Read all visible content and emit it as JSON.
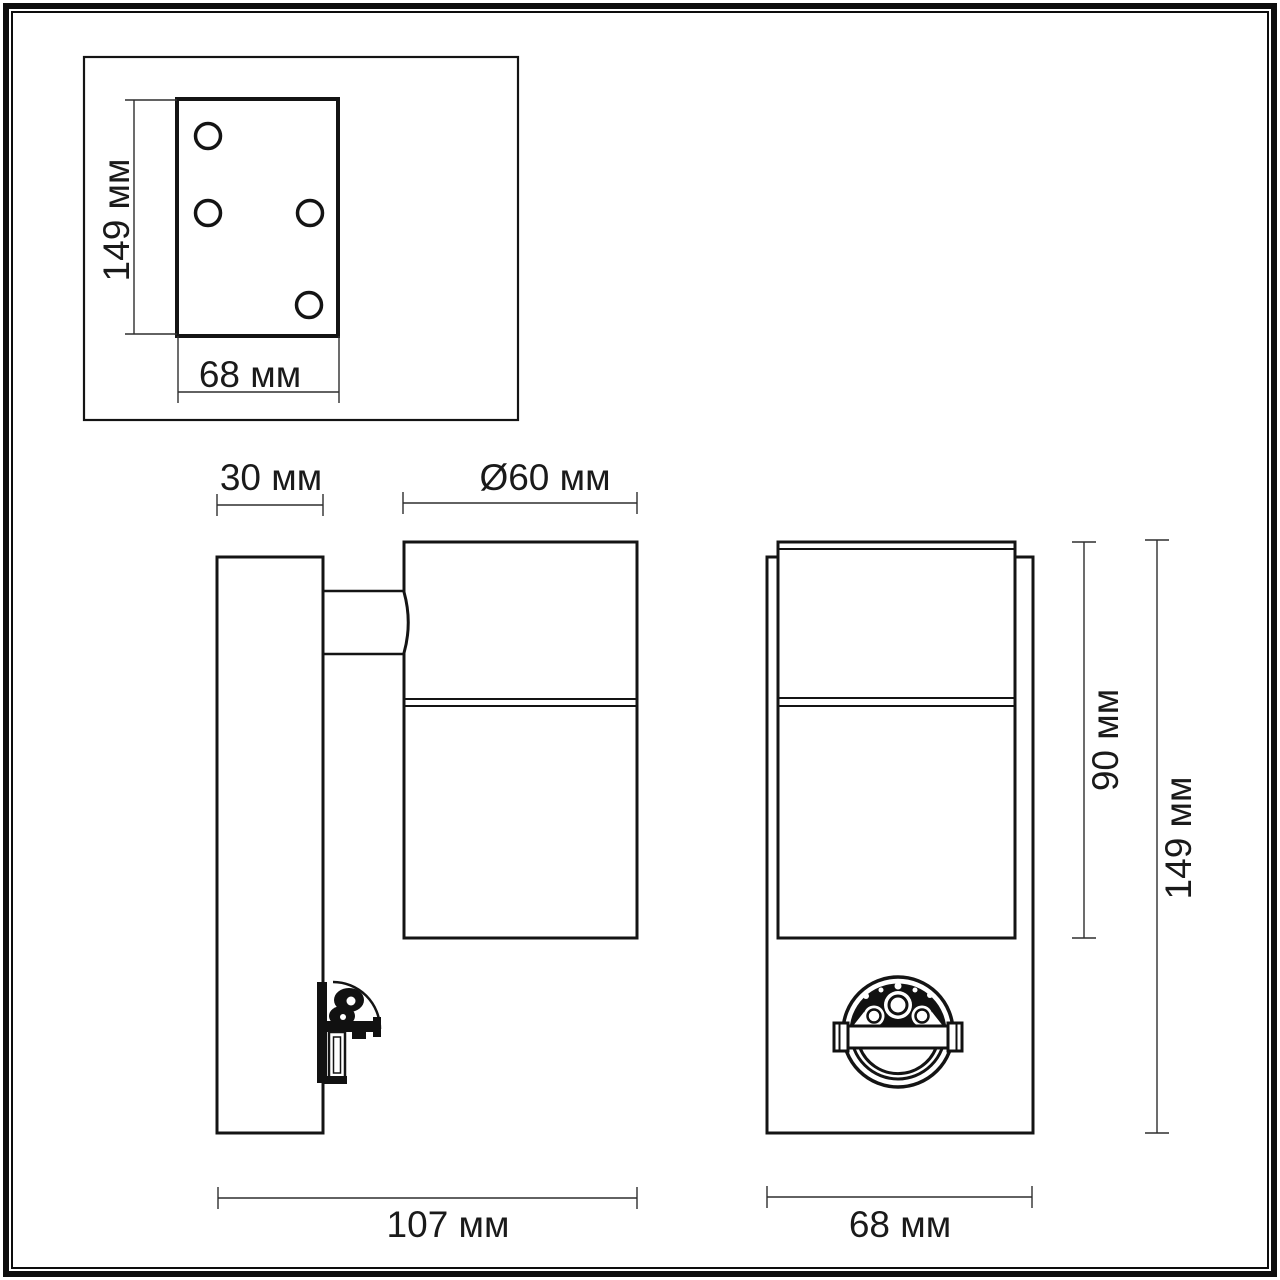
{
  "colors": {
    "line": "#141414",
    "dimension_line": "#2e2e2e",
    "background": "#ffffff"
  },
  "views": {
    "mounting_plate_view": {
      "dim_height": "149 мм",
      "dim_width": "68 мм"
    },
    "side_view": {
      "dim_wall_plate_depth": "30 мм",
      "dim_diameter": "Ø60 мм",
      "dim_total_depth": "107 мм"
    },
    "front_view": {
      "dim_body_height": "90 мм",
      "dim_total_height": "149 мм",
      "dim_width": "68 мм"
    }
  }
}
